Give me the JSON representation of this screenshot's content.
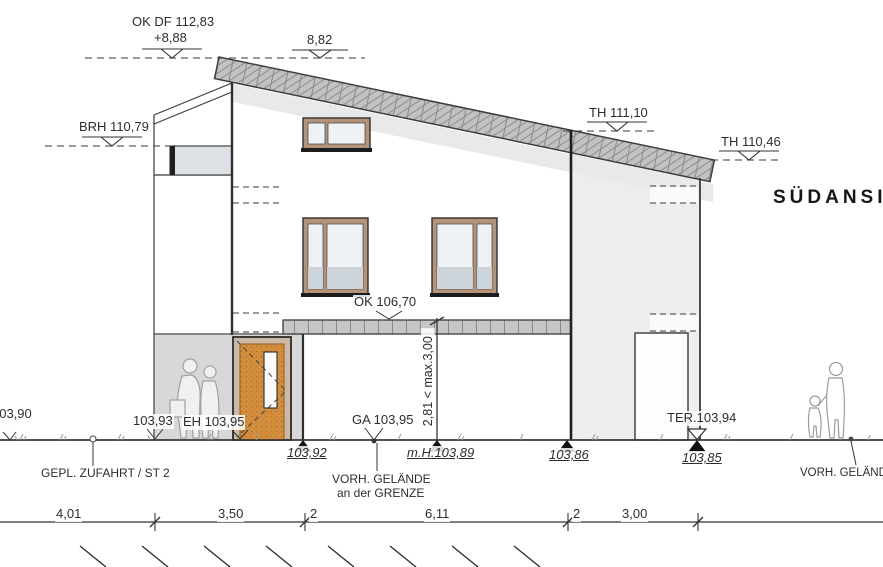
{
  "drawing_title": "SÜDANSICHT",
  "level_markers": {
    "roof_top": {
      "label": "OK DF 112,83",
      "relative": "+8,88"
    },
    "roof_top_right": "8,82",
    "parapet": "BRH 110,79",
    "wall_top_main": "TH 111,10",
    "wall_top_low": "TH 110,46",
    "canopy_top": "OK 106,70"
  },
  "ground_points": {
    "far_left": "103,90",
    "left_wing": "103,93",
    "entrance": "EH 103,95",
    "boundary": "GA 103,95",
    "corner": "103,92",
    "middle": "m.H.103,89",
    "right_of_house": "103,86",
    "terrace": "TER.103,94",
    "far_right": "103,85"
  },
  "notes": {
    "driveway": "GEPL. ZUFAHRT / ST 2",
    "grade_boundary_line1": "VORH. GELÄNDE",
    "grade_boundary_line2": "an der GRENZE",
    "grade_right": "VORH. GELÄNDE",
    "height_check": "2,81 < max.3,00"
  },
  "dimension_chain": [
    "4,01",
    "3,50",
    "2",
    "6,11",
    "2",
    "3,00"
  ],
  "colors": {
    "roof_hatch": "#c2c2c2",
    "facade": "#ffffff",
    "side_wing": "#ededed",
    "entrance_recess": "#d8d8d8",
    "window_frame": "#b3947a",
    "glass": "#eef2f5",
    "glass_lower": "#ccd3d9",
    "door": "#d48f3e",
    "line": "#3a3a3a"
  }
}
